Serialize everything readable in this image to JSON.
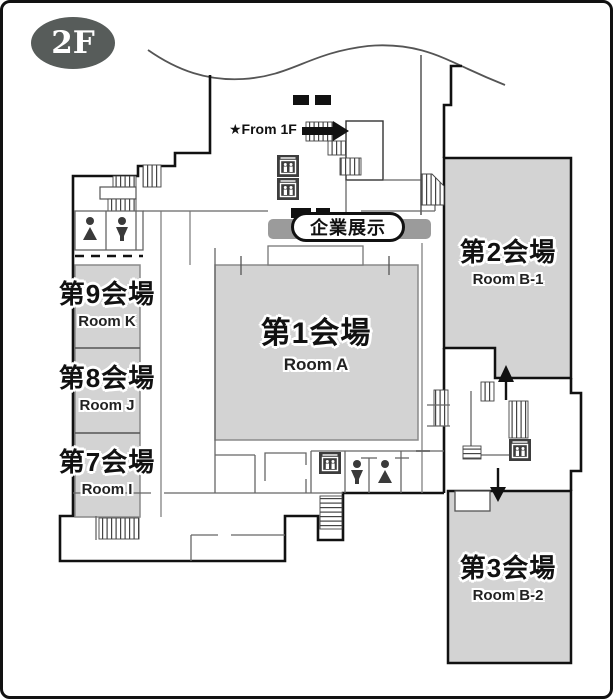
{
  "floor_badge": "2F",
  "entrance_note": "★From 1F",
  "exhibition_label": "企業展示",
  "rooms": [
    {
      "jp": "第1会場",
      "en": "Room A"
    },
    {
      "jp": "第2会場",
      "en": "Room B-1"
    },
    {
      "jp": "第3会場",
      "en": "Room B-2"
    },
    {
      "jp": "第7会場",
      "en": "Room I"
    },
    {
      "jp": "第8会場",
      "en": "Room J"
    },
    {
      "jp": "第9会場",
      "en": "Room K"
    }
  ],
  "icons": {
    "elevator": "elevator-icon",
    "restroom_female": "restroom-female-icon",
    "restroom_male": "restroom-male-icon",
    "stairs": "stairs-hatch",
    "arrow_from_1f": "arrow-right-icon",
    "arrow_up": "arrow-up-icon",
    "arrow_down": "arrow-down-icon"
  },
  "colors": {
    "room_fill": "#d3d3d3",
    "wall": "#111111",
    "partition": "#666666",
    "exhibit_bar": "#9b9b9b",
    "badge": "#575c5a",
    "elevator_box": "#3d3d3d"
  }
}
